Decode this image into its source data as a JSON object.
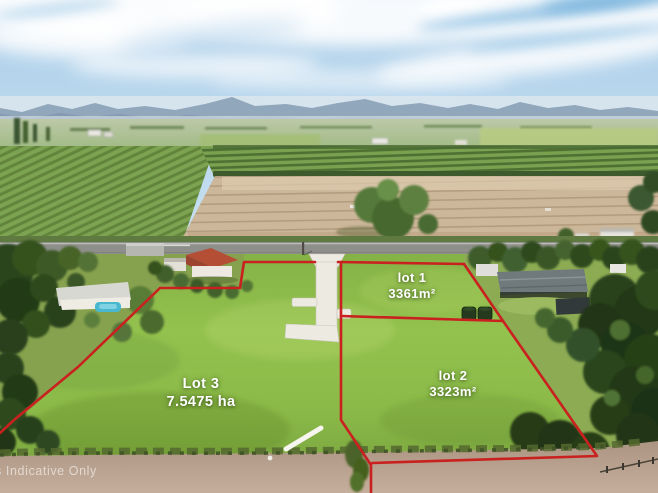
{
  "labels": {
    "lot1": {
      "name": "lot 1",
      "area": "3361m²"
    },
    "lot2": {
      "name": "lot 2",
      "area": "3323m²"
    },
    "lot3": {
      "name": "Lot 3",
      "area": "7.5475 ha"
    }
  },
  "watermark": {
    "text": "s Indicative Only"
  },
  "colors": {
    "boundary": "#c8211f",
    "driveway": "#edeae1",
    "label_text": "#ffffff",
    "sky": "#bdd8ec",
    "grass": "#8ebd4a",
    "dirt": "#bca491"
  }
}
